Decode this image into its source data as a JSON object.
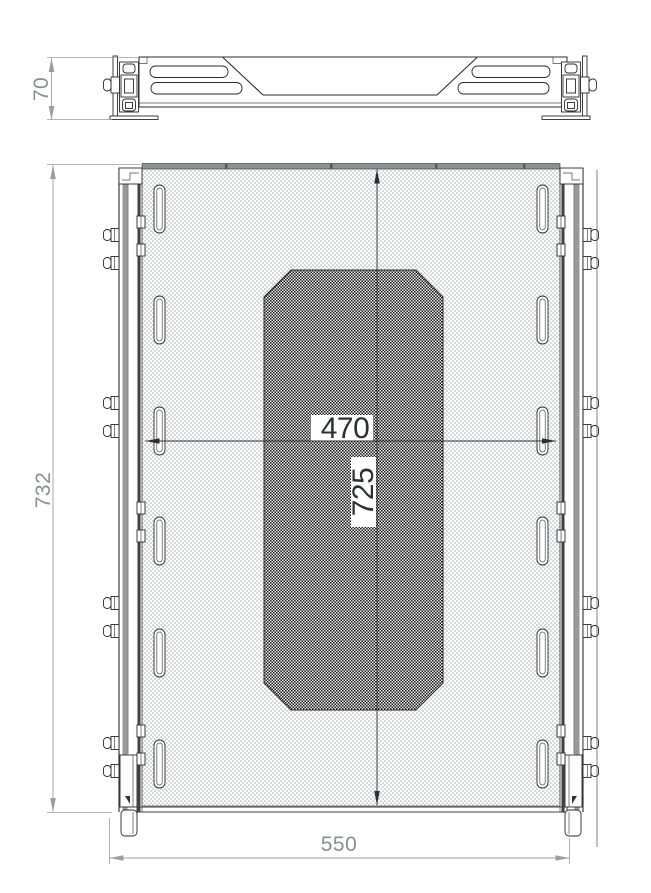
{
  "drawing": {
    "dimensions": {
      "side_height": "70",
      "overall_length": "732",
      "opening_width": "470",
      "opening_length": "725",
      "overall_width": "550"
    },
    "colors": {
      "part_line": "#2b2b2b",
      "dimension_line_gray": "#9a9ea1",
      "dimension_text_gray": "#8a8e91",
      "dimension_text_dark": "#2d3033",
      "mesh_light": "#d7dadc",
      "mesh_dark": "#1c1c1c",
      "rail_gray": "#97999b",
      "background": "#ffffff"
    }
  }
}
